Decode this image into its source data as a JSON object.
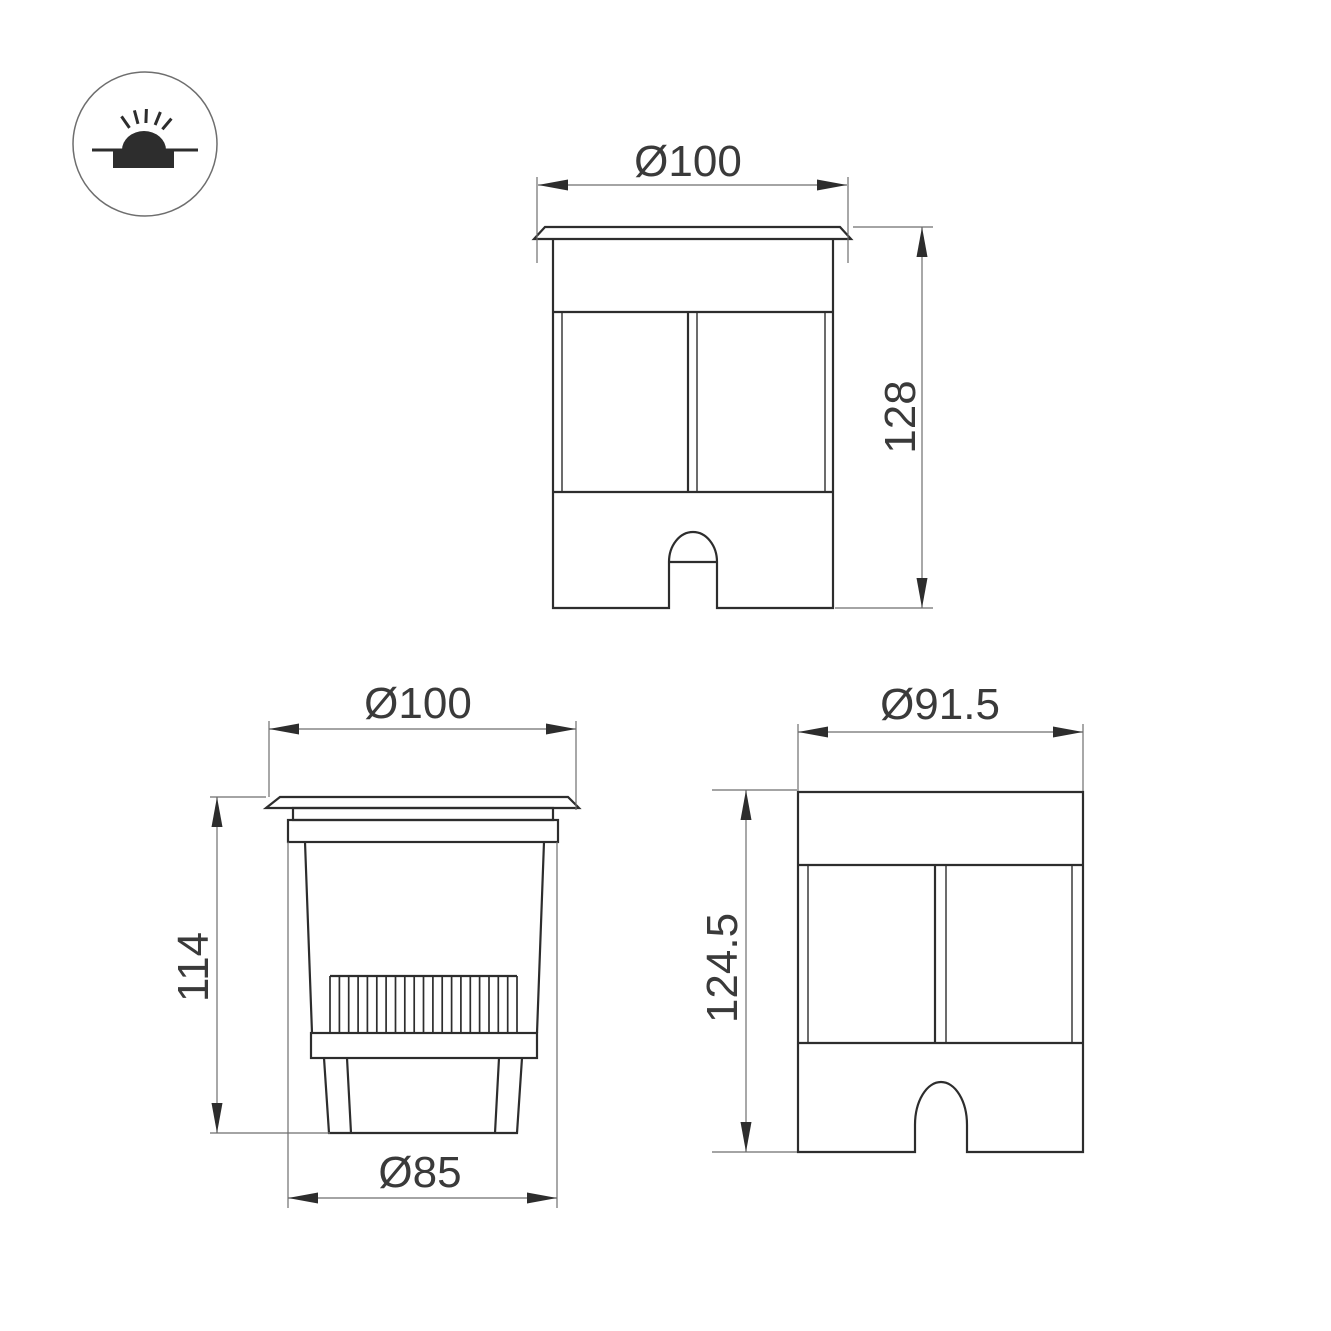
{
  "icon": {
    "name": "recessed-inground-light-symbol"
  },
  "views": {
    "front": {
      "width_label": "Ø100",
      "height_label": "128"
    },
    "section": {
      "width_label": "Ø100",
      "height_label": "114",
      "base_label": "Ø85"
    },
    "side": {
      "width_label": "Ø91.5",
      "height_label": "124.5"
    }
  },
  "colors": {
    "outline": "#2d2d2d",
    "dimension": "#6e6e6e",
    "text": "#3a3a3a",
    "background": "#ffffff"
  }
}
